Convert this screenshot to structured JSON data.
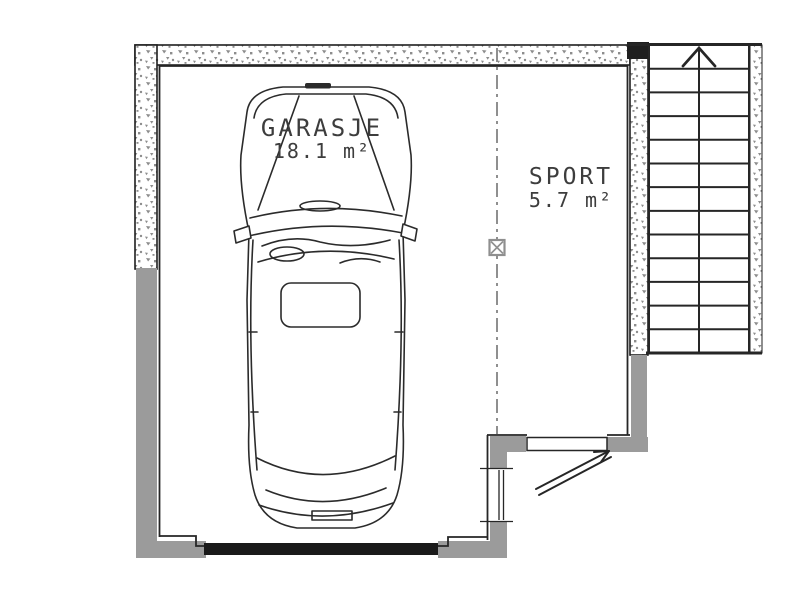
{
  "title": "Garage floor plan",
  "rooms": [
    {
      "id": "garasje",
      "name": "GARASJE",
      "area": "18.1 m²"
    },
    {
      "id": "sport",
      "name": "SPORT",
      "area": "5.7 m²"
    }
  ],
  "stairs": {
    "steps": 13,
    "direction": "up",
    "arrow_icon": "up-arrow"
  },
  "markers": {
    "post_marker": "x-box"
  },
  "colors": {
    "background": "#ffffff",
    "line": "#2b2b2b",
    "wall_fill_gray": "#9b9b9b",
    "speckle_gray": "#8d8d8d",
    "divider_gray": "#8f8f8f",
    "label_text": "#3d3d3d"
  }
}
